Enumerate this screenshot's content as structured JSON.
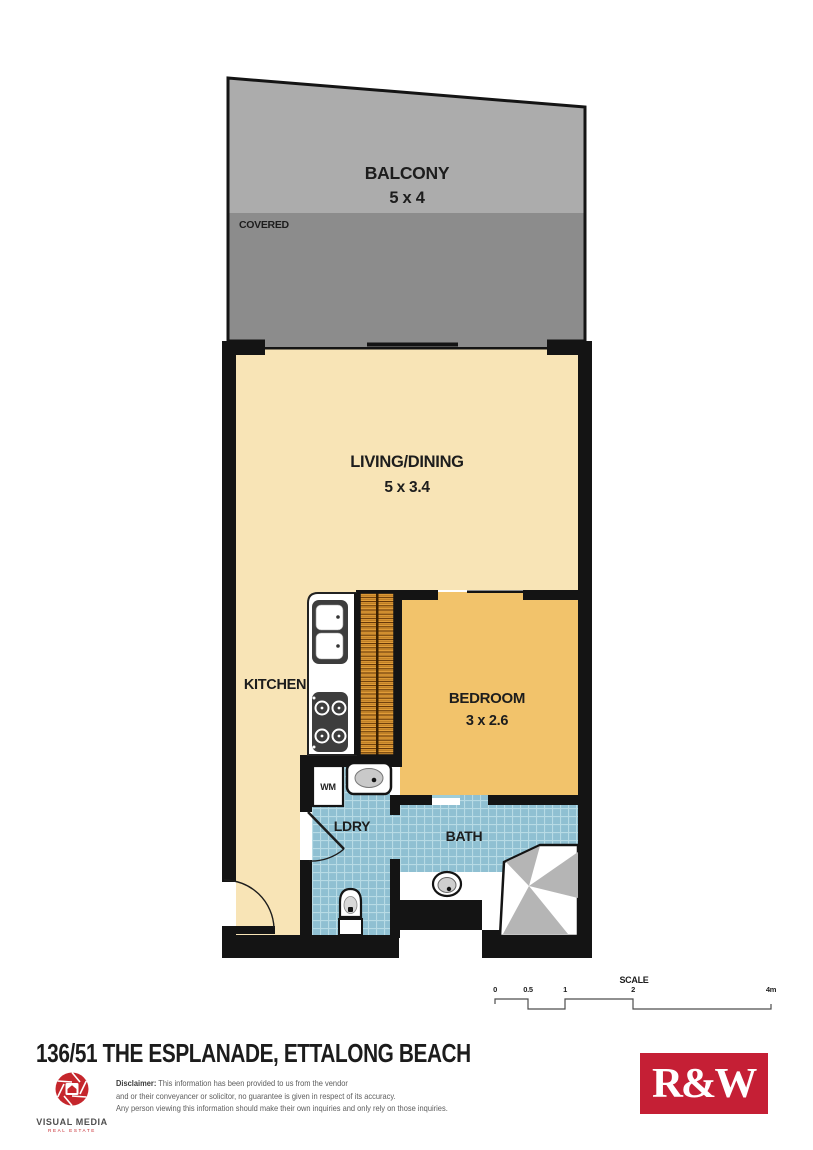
{
  "plan": {
    "balcony": {
      "label": "BALCONY",
      "dims": "5 x 4",
      "covered_label": "COVERED"
    },
    "living": {
      "label": "LIVING/DINING",
      "dims": "5 x 3.4"
    },
    "kitchen": {
      "label": "KITCHEN"
    },
    "bedroom": {
      "label": "BEDROOM",
      "dims": "3 x 2.6"
    },
    "laundry": {
      "label": "LDRY",
      "washing_machine_label": "WM"
    },
    "bath": {
      "label": "BATH"
    },
    "colors": {
      "floor_cream": "#f8e4b6",
      "floor_orange": "#f2c36b",
      "tile_blue": "#8fc0d2",
      "balcony_gray": "#acacac",
      "covered_gray": "#8c8c8c",
      "wall_black": "#141414",
      "wardrobe_orange": "#e7a23b",
      "shower_gray": "#b5b5b5"
    }
  },
  "scale_bar": {
    "title": "SCALE",
    "ticks": [
      "0",
      "0.5",
      "1",
      "2",
      "4m"
    ]
  },
  "footer": {
    "address": "136/51 THE ESPLANADE, ETTALONG BEACH",
    "visual_media": {
      "name": "VISUAL MEDIA",
      "tagline": "REAL ESTATE"
    },
    "disclaimer": {
      "label": "Disclaimer:",
      "line1": "This information has been provided to us from the vendor",
      "line2": "and or their conveyancer or solicitor, no guarantee is given in respect of its accuracy.",
      "line3": "Any person viewing this information should make their own inquiries and only rely on those inquiries."
    },
    "agency": {
      "logo_text": "R&W",
      "color": "#c51f35"
    }
  }
}
